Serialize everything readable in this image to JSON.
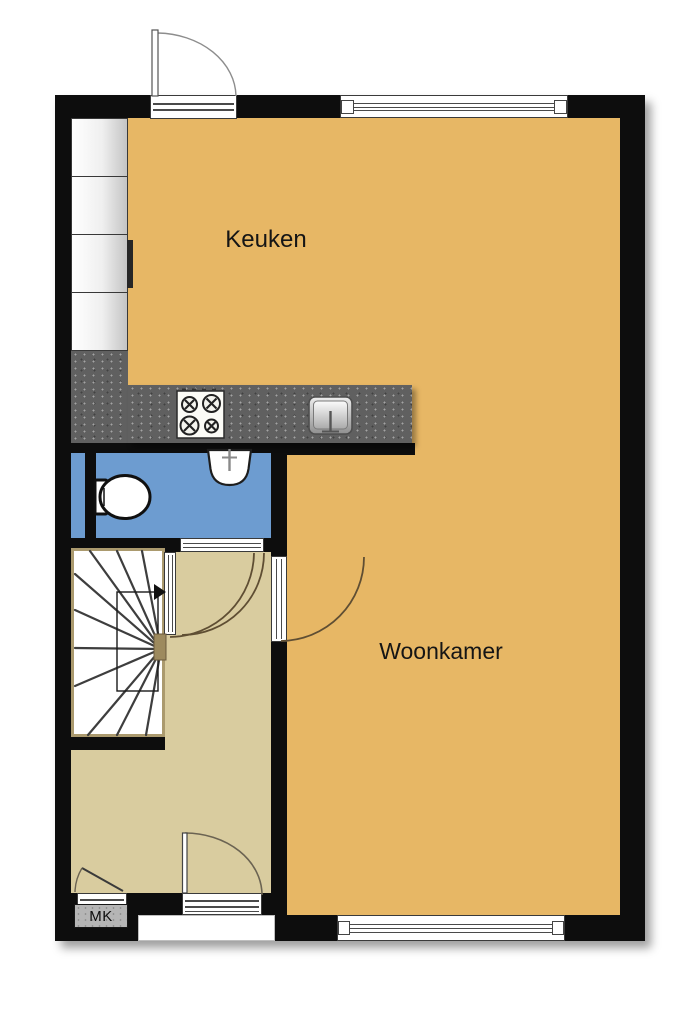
{
  "labels": {
    "keuken": "Keuken",
    "woonkamer": "Woonkamer",
    "meterkast": "MK"
  },
  "rooms": [
    {
      "name": "keuken",
      "label": "Keuken",
      "floor_color": "#e7b765"
    },
    {
      "name": "woonkamer",
      "label": "Woonkamer",
      "floor_color": "#e7b765"
    },
    {
      "name": "hal",
      "label": "",
      "floor_color": "#d9cc9f"
    },
    {
      "name": "toiletruimte",
      "label": "",
      "floor_color": "#6d9cd0"
    },
    {
      "name": "meterkast",
      "label": "MK",
      "floor_color": "#b5b5b5"
    }
  ],
  "colors": {
    "wall": "#0d0d0d",
    "kitchen_living_floor": "#e7b765",
    "hall_floor": "#d9cc9f",
    "toilet_floor": "#6d9cd0",
    "counter": "#606060",
    "stair_frame": "#ab9a6e",
    "interior_door_arc": "#5f4e33",
    "exterior_door_arc": "#8d8d8d",
    "background": "#ffffff"
  },
  "fixtures": {
    "stove": "stove-4-burner-icon",
    "kitchen_sink": "kitchen-sink-icon",
    "washbasin": "washbasin-icon",
    "toilet": "toilet-icon",
    "staircase": "winder-staircase-icon",
    "cabinets": "kitchen-cabinet-row-icon",
    "meter_cupboard": "meter-cupboard-icon"
  }
}
